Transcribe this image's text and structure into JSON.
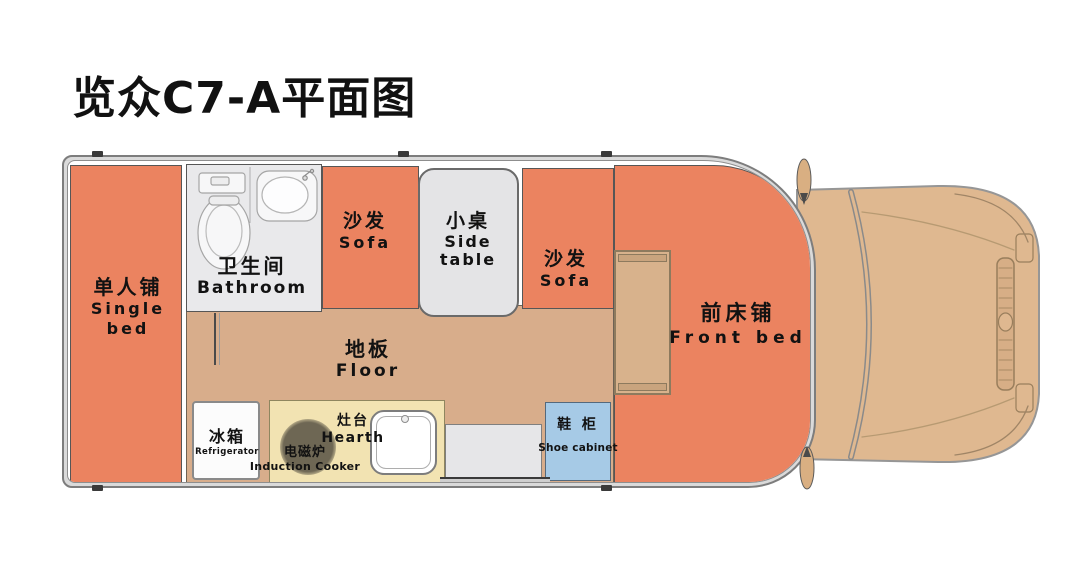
{
  "title": "览众C7-A平面图",
  "colors": {
    "bed_orange": "#EB8360",
    "floor_tan": "#D8AD8B",
    "counter_yellow": "#F2E3B2",
    "bathroom_gray": "#E9E9EB",
    "side_table_gray": "#E4E4E6",
    "entry_step_gray": "#E6E6E8",
    "shoe_cabinet_blue": "#A6CAE6",
    "cab_tan": "#DFB890",
    "wall_gray": "#7d7d7d"
  },
  "rooms": {
    "single_bed": {
      "zh": "单人铺",
      "en": "Single bed"
    },
    "bathroom": {
      "zh": "卫生间",
      "en": "Bathroom"
    },
    "sofa_left": {
      "zh": "沙发",
      "en": "Sofa"
    },
    "side_table": {
      "zh": "小桌",
      "en": "Side table"
    },
    "sofa_right": {
      "zh": "沙发",
      "en": "Sofa"
    },
    "floor": {
      "zh": "地板",
      "en": "Floor"
    },
    "refrigerator": {
      "zh": "冰箱",
      "en": "Refrigerator"
    },
    "induction_cooker": {
      "zh": "电磁炉",
      "en": "Induction Cooker"
    },
    "hearth": {
      "zh": "灶台",
      "en": "Hearth"
    },
    "shoe_cabinet": {
      "zh": "鞋 柜",
      "en": "Shoe cabinet"
    },
    "front_bed": {
      "zh": "前床铺",
      "en": "Front bed"
    }
  }
}
